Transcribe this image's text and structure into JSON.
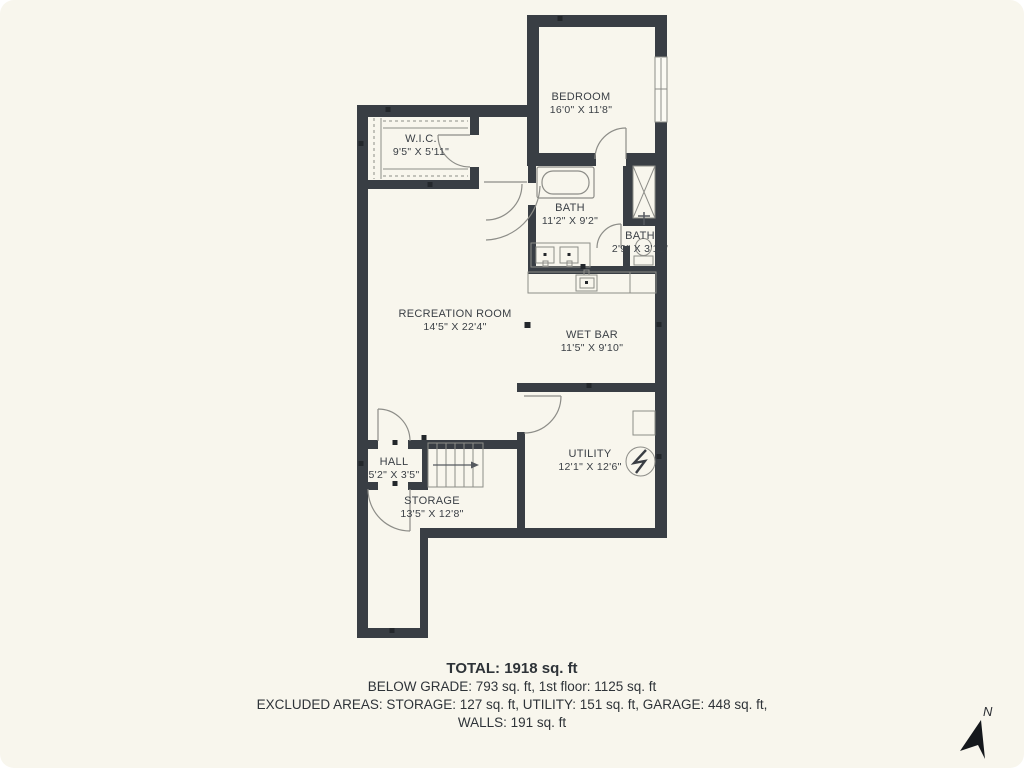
{
  "colors": {
    "background": "#f8f6ed",
    "wall": "#393e44",
    "thin_line": "#8d8d88",
    "text": "#3b4046",
    "compass": "#15181c"
  },
  "rooms": {
    "bedroom": {
      "name": "BEDROOM",
      "dims": "16'0\" X 11'8\""
    },
    "wic": {
      "name": "W.I.C.",
      "dims": "9'5\" X 5'11\""
    },
    "bath": {
      "name": "BATH",
      "dims": "11'2\" X 9'2\""
    },
    "bath_small": {
      "name": "BATH",
      "dims": "2'9\" X 3'11\""
    },
    "recreation": {
      "name": "RECREATION ROOM",
      "dims": "14'5\" X 22'4\""
    },
    "wet_bar": {
      "name": "WET BAR",
      "dims": "11'5\" X 9'10\""
    },
    "hall": {
      "name": "HALL",
      "dims": "5'2\" X 3'5\""
    },
    "storage": {
      "name": "STORAGE",
      "dims": "13'5\" X 12'8\""
    },
    "utility": {
      "name": "UTILITY",
      "dims": "12'1\" X 12'6\""
    }
  },
  "summary": {
    "total": "TOTAL: 1918 sq. ft",
    "below_grade": "BELOW GRADE: 793 sq. ft, 1st floor: 1125 sq. ft",
    "excluded": "EXCLUDED AREAS: STORAGE: 127 sq. ft, UTILITY: 151 sq. ft, GARAGE: 448 sq. ft,",
    "walls": "WALLS: 191 sq. ft"
  },
  "compass": {
    "label": "N"
  }
}
